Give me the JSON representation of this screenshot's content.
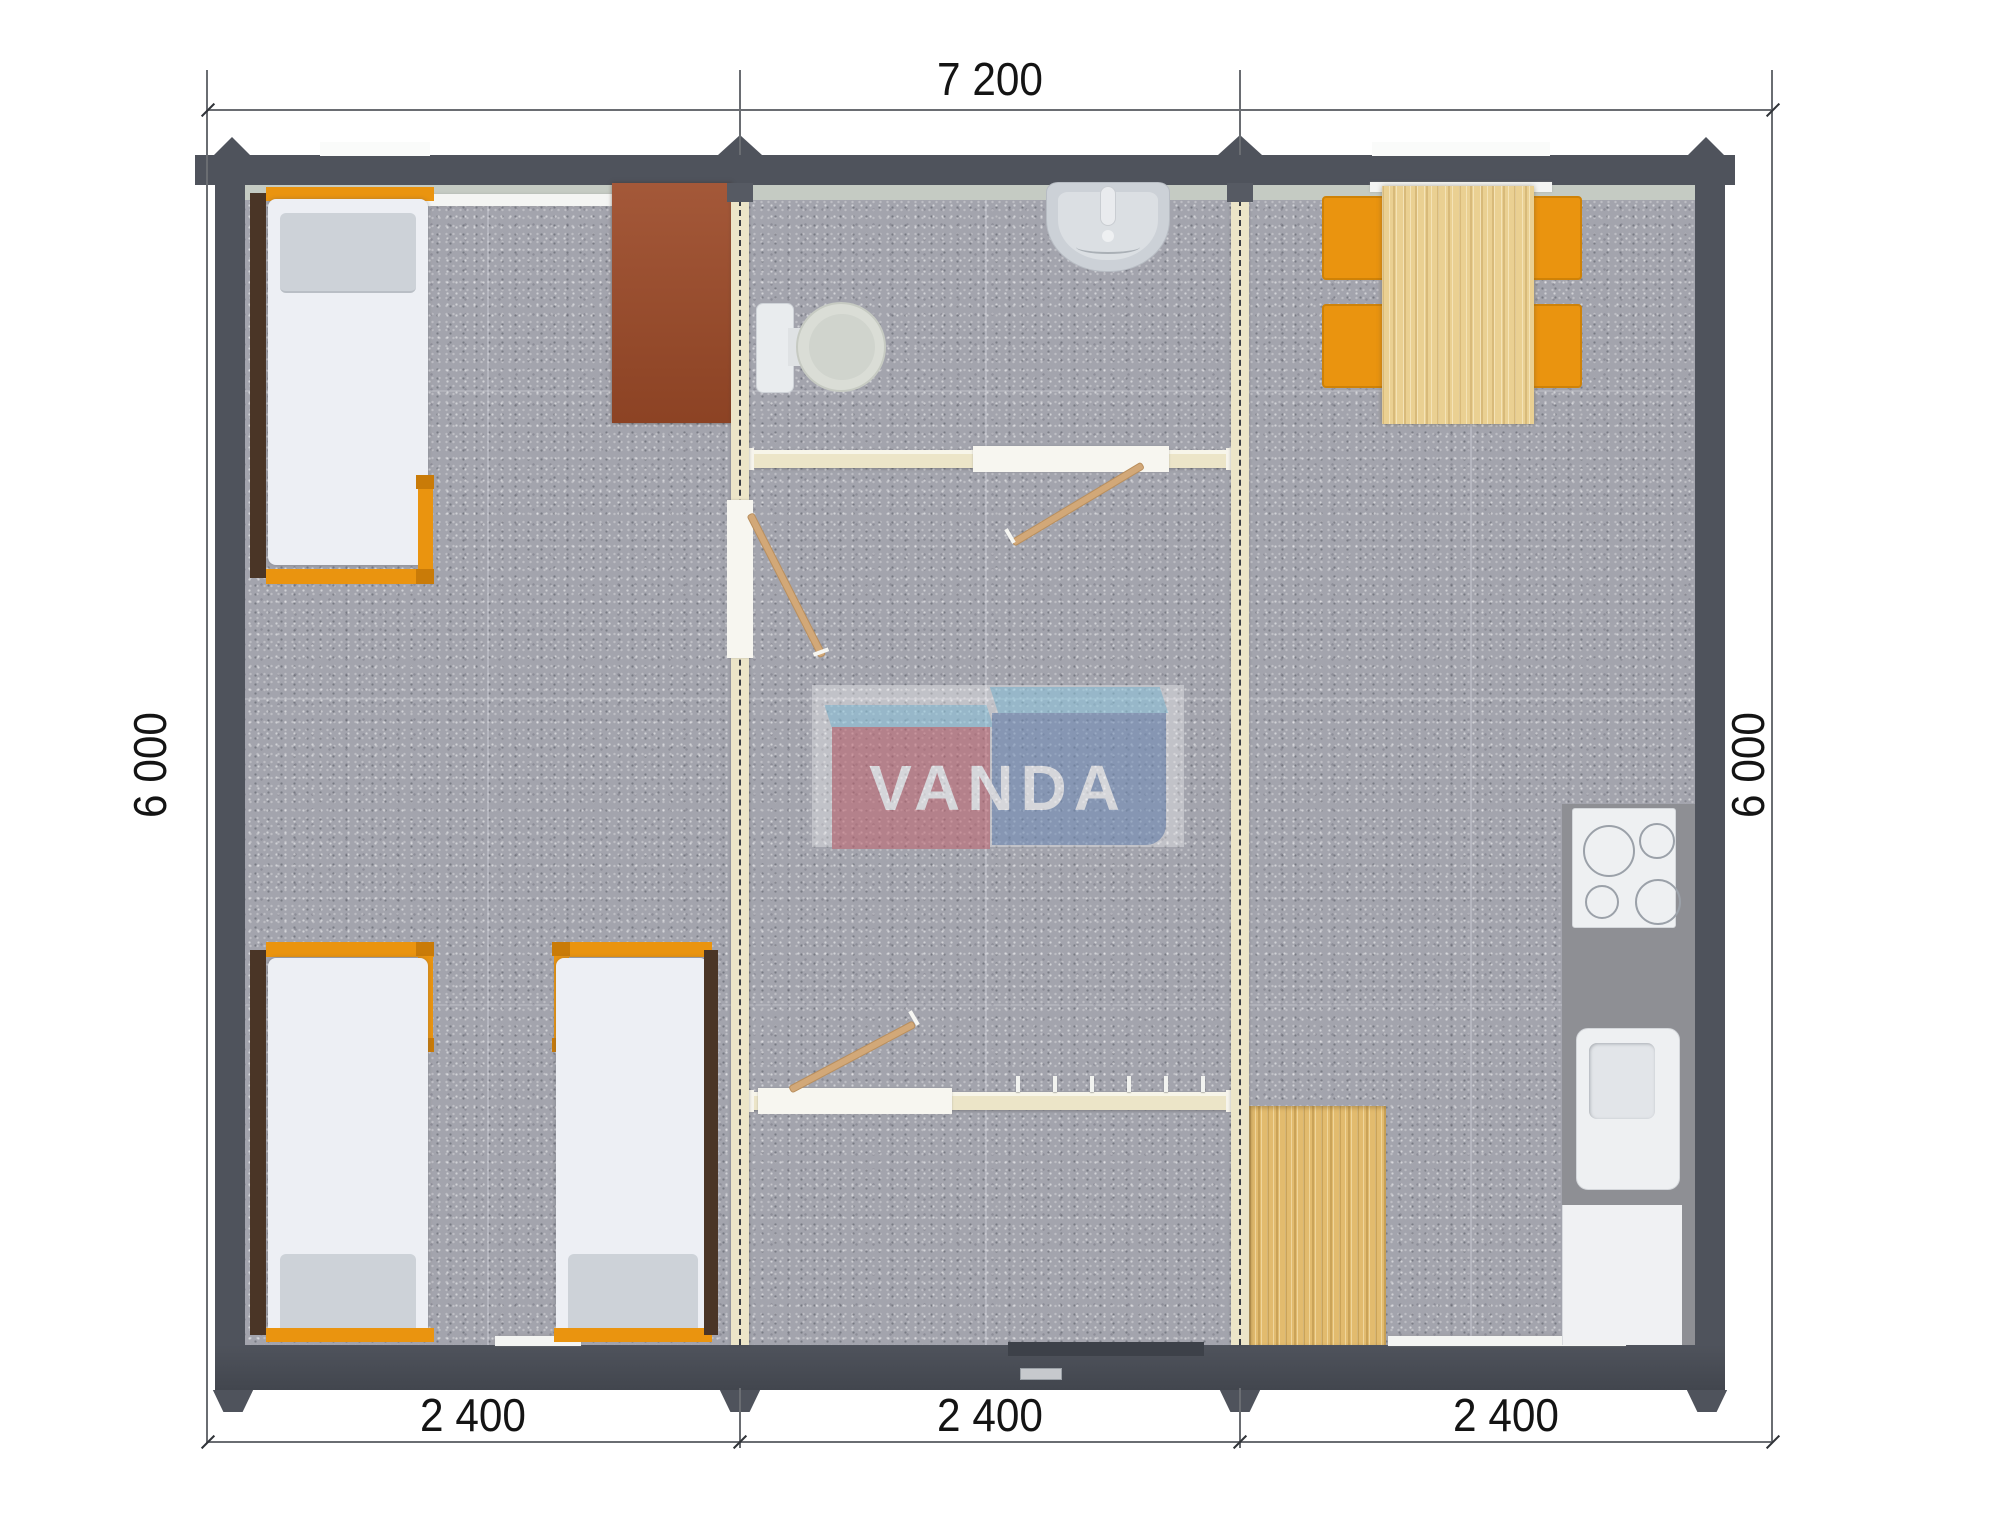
{
  "plan": {
    "watermark": {
      "text": "VANDA",
      "red": "#c26570",
      "blue": "#6f8cb8",
      "light_blue": "#8ec8e0"
    },
    "dimensions": {
      "top": "7 200",
      "bottom": [
        "2 400",
        "2 400",
        "2 400"
      ],
      "left": "6 000",
      "right": "6 000"
    },
    "fixture_icons": [
      "single-bed",
      "single-bed",
      "single-bed",
      "cabinet",
      "toilet",
      "wash-basin",
      "interior-door",
      "interior-door",
      "interior-door",
      "coat-hooks",
      "entrance-door",
      "dining-table",
      "chair",
      "chair",
      "chair",
      "chair",
      "cooktop",
      "kitchen-sink",
      "base-cabinet",
      "wood-deck",
      "kitchen-counter",
      "window",
      "window",
      "window",
      "window"
    ],
    "colors": {
      "wall": "#4f535c",
      "floor": "#a3a4ad",
      "partition": "#ece5c8",
      "furniture_orange": "#ea940f",
      "table_wood": "#ead092",
      "deck_wood": "#e2bb6e",
      "cabinet_brown": "#9c4a28"
    }
  }
}
